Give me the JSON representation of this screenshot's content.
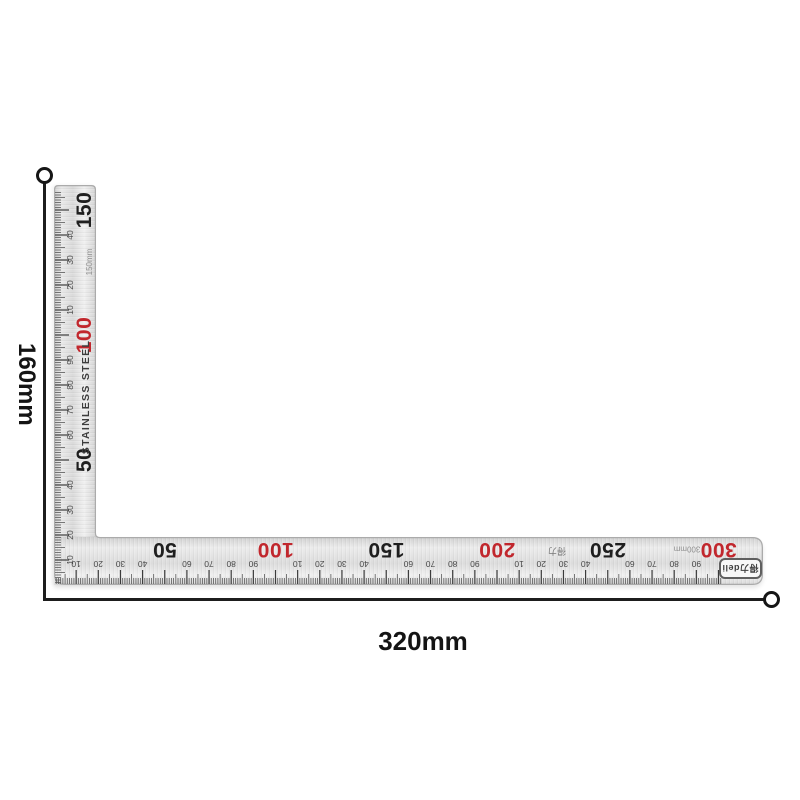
{
  "annotations": {
    "height_label": "160mm",
    "width_label": "320mm"
  },
  "ruler": {
    "material_text": "STAINLESS STEEL",
    "brand_badge_text": "得力deli",
    "accent_red": "#c1272d",
    "ink_black": "#1f1f1f",
    "vertical_scale": {
      "unit_label": "150mm",
      "max_mm": 150,
      "major_marks": [
        {
          "mm": 50,
          "label": "50",
          "color": "#1f1f1f"
        },
        {
          "mm": 100,
          "label": "100",
          "color": "#c1272d"
        },
        {
          "mm": 150,
          "label": "150",
          "color": "#1f1f1f"
        }
      ],
      "minor_marks": [
        {
          "mm": 10,
          "label": "10"
        },
        {
          "mm": 20,
          "label": "20"
        },
        {
          "mm": 30,
          "label": "30"
        },
        {
          "mm": 40,
          "label": "40"
        },
        {
          "mm": 60,
          "label": "60"
        },
        {
          "mm": 70,
          "label": "70"
        },
        {
          "mm": 80,
          "label": "80"
        },
        {
          "mm": 90,
          "label": "90"
        },
        {
          "mm": 110,
          "label": "10"
        },
        {
          "mm": 120,
          "label": "20"
        },
        {
          "mm": 130,
          "label": "30"
        },
        {
          "mm": 140,
          "label": "40"
        }
      ]
    },
    "horizontal_scale": {
      "unit_label": "300mm",
      "cn_label": "得力",
      "max_mm": 300,
      "major_marks": [
        {
          "mm": 50,
          "label": "50",
          "color": "#1f1f1f"
        },
        {
          "mm": 100,
          "label": "100",
          "color": "#c1272d"
        },
        {
          "mm": 150,
          "label": "150",
          "color": "#1f1f1f"
        },
        {
          "mm": 200,
          "label": "200",
          "color": "#c1272d"
        },
        {
          "mm": 250,
          "label": "250",
          "color": "#1f1f1f"
        },
        {
          "mm": 300,
          "label": "300",
          "color": "#c1272d"
        }
      ],
      "minor_marks": [
        {
          "mm": 10,
          "label": "10"
        },
        {
          "mm": 20,
          "label": "20"
        },
        {
          "mm": 30,
          "label": "30"
        },
        {
          "mm": 40,
          "label": "40"
        },
        {
          "mm": 60,
          "label": "60"
        },
        {
          "mm": 70,
          "label": "70"
        },
        {
          "mm": 80,
          "label": "80"
        },
        {
          "mm": 90,
          "label": "90"
        },
        {
          "mm": 110,
          "label": "10"
        },
        {
          "mm": 120,
          "label": "20"
        },
        {
          "mm": 130,
          "label": "30"
        },
        {
          "mm": 140,
          "label": "40"
        },
        {
          "mm": 160,
          "label": "60"
        },
        {
          "mm": 170,
          "label": "70"
        },
        {
          "mm": 180,
          "label": "80"
        },
        {
          "mm": 190,
          "label": "90"
        },
        {
          "mm": 210,
          "label": "10"
        },
        {
          "mm": 220,
          "label": "20"
        },
        {
          "mm": 230,
          "label": "30"
        },
        {
          "mm": 240,
          "label": "40"
        },
        {
          "mm": 260,
          "label": "60"
        },
        {
          "mm": 270,
          "label": "70"
        },
        {
          "mm": 280,
          "label": "80"
        },
        {
          "mm": 290,
          "label": "90"
        }
      ]
    }
  }
}
